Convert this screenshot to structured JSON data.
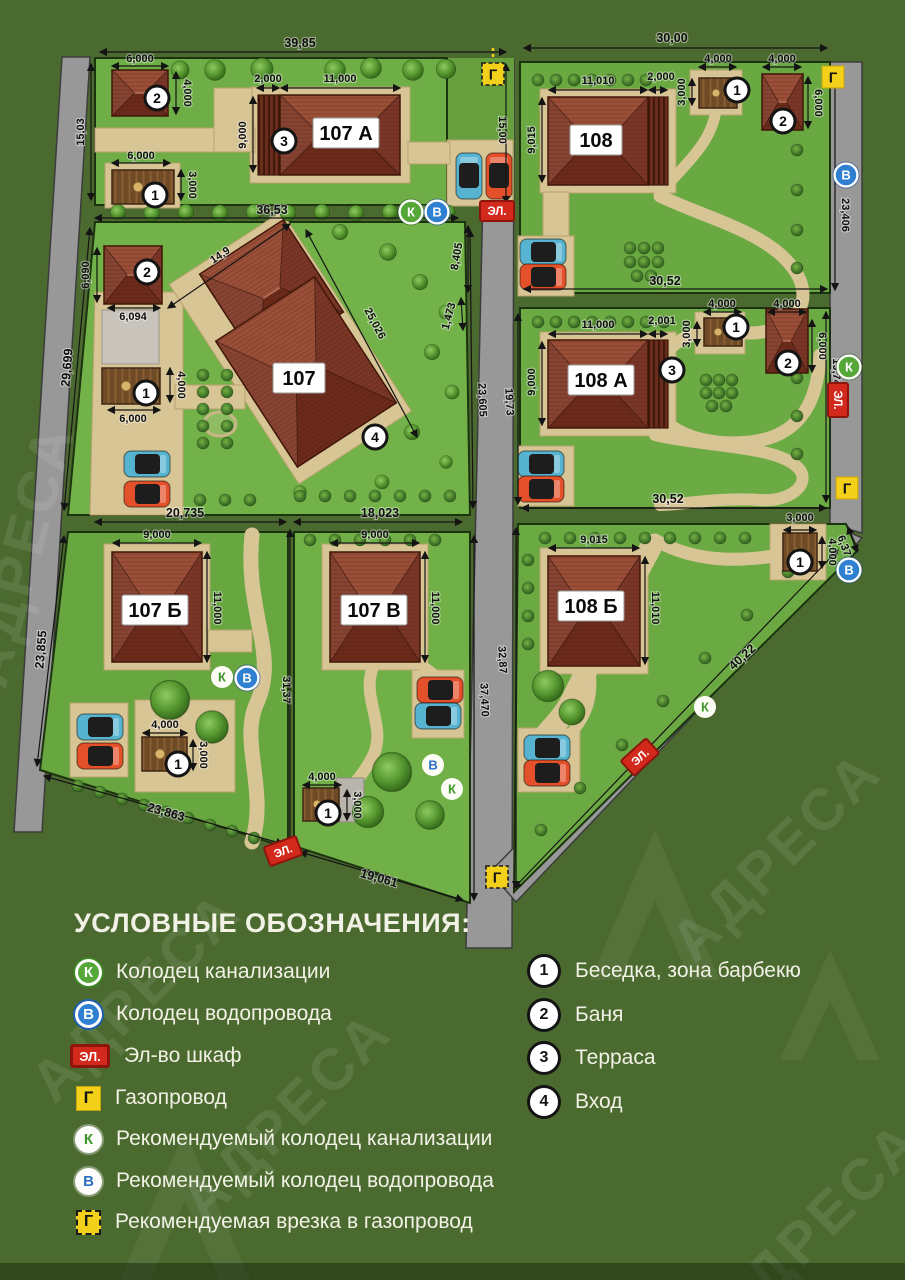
{
  "watermark": "АДРЕСА",
  "symbols": {
    "sewer": "К",
    "water": "В",
    "electric": "ЭЛ.",
    "gas": "Г",
    "m1": "1",
    "m2": "2",
    "m3": "3",
    "m4": "4"
  },
  "plots": {
    "p107a": {
      "name": "107 А"
    },
    "p108": {
      "name": "108"
    },
    "p107": {
      "name": "107"
    },
    "p108a": {
      "name": "108 А"
    },
    "p107b": {
      "name": "107 Б"
    },
    "p107v": {
      "name": "107 В"
    },
    "p108b": {
      "name": "108 Б"
    }
  },
  "dims": {
    "a_top": "39,85",
    "a_left": "15,03",
    "a_right": "15,00",
    "a_bottom": "36,53",
    "a_bath_w": "6,000",
    "a_bath_h": "4,000",
    "a_gaz_w": "6,000",
    "a_gaz_h": "3,000",
    "a_terr": "2,000",
    "a_house_w": "11,000",
    "a_house_h": "9,000",
    "b8_top": "30,00",
    "b8_right": "23,406",
    "b8_bottom": "30,52",
    "b8_house_w": "11,010",
    "b8_terr": "2,000",
    "b8_house_h": "9,015",
    "b8_s1w": "4,000",
    "b8_s1h": "3,000",
    "b8_s2w": "4,000",
    "b8_s2h": "6,000",
    "p7_left": "29,699",
    "p7_diag1": "14,9",
    "p7_diag2": "25,026",
    "p7_bath_w": "6,094",
    "p7_bath_h": "6,090",
    "p7_gaz_w": "6,000",
    "p7_gaz_h": "4,000",
    "p7_bot_l": "20,735",
    "p7_bot_r": "18,023",
    "p7_right": "23,605",
    "rd_8405": "8,405",
    "rd_1473": "1,473",
    "a8_left": "19,73",
    "a8_right": "19,74",
    "a8_bottom": "30,52",
    "a8_house_w": "11,000",
    "a8_terr": "2,001",
    "a8_house_h": "9,000",
    "a8_s1w": "4,000",
    "a8_s1h": "3,000",
    "a8_s2w": "4,000",
    "a8_s2h": "6,000",
    "b7_left": "23,855",
    "b7_house_w": "9,000",
    "b7_house_h": "11,000",
    "b7_gaz_w": "4,000",
    "b7_gaz_h": "3,000",
    "b7_bottom": "23,863",
    "b7_bound": "31,37",
    "v7_house_w": "9,000",
    "v7_house_h": "11,000",
    "v7_gaz_w": "4,000",
    "v7_gaz_h": "3,000",
    "v7_bottom": "19,061",
    "v7_right": "37,470",
    "bb_left": "32,87",
    "bb_house_w": "9,015",
    "bb_house_h": "11,010",
    "bb_gaz_w": "3,000",
    "bb_gaz_h": "4,000",
    "bb_right": "6,37",
    "bb_diag": "40,22"
  },
  "legend": {
    "title": "УСЛОВНЫЕ ОБОЗНАЧЕНИЯ:",
    "items_left": [
      {
        "label": "Колодец канализации"
      },
      {
        "label": "Колодец водопровода"
      },
      {
        "label": "Эл-во шкаф"
      },
      {
        "label": "Газопровод"
      },
      {
        "label": "Рекомендуемый колодец канализации"
      },
      {
        "label": "Рекомендуемый колодец водопровода"
      },
      {
        "label": "Рекомендуемая врезка в газопровод"
      }
    ],
    "items_right": [
      {
        "num": "1",
        "label": "Беседка, зона барбекю"
      },
      {
        "num": "2",
        "label": "Баня"
      },
      {
        "num": "3",
        "label": "Терраса"
      },
      {
        "num": "4",
        "label": "Вход"
      }
    ]
  }
}
